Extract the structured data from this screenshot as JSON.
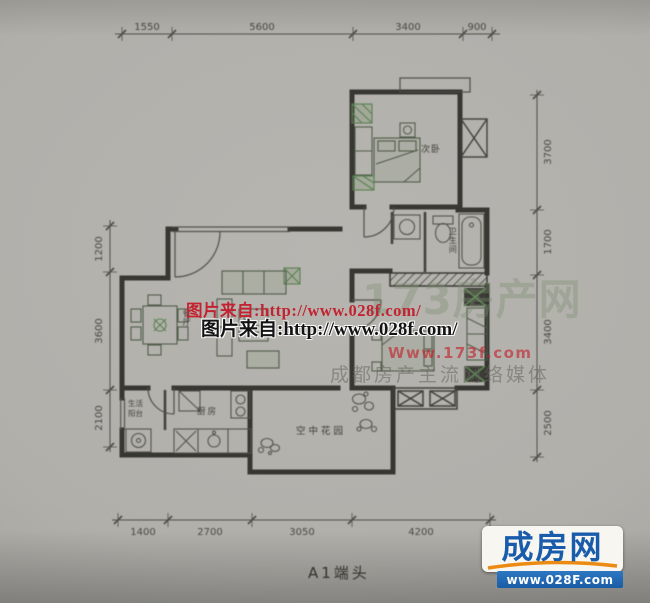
{
  "title": "A1端头",
  "dimensions": {
    "top": [
      "1550",
      "5600",
      "3400",
      "900"
    ],
    "bottom": [
      "1400",
      "2700",
      "3050",
      "4200"
    ],
    "left": [
      "1200",
      "3600",
      "2100"
    ],
    "right": [
      "3700",
      "1700",
      "3400",
      "2500"
    ]
  },
  "rooms": {
    "secondary_bedroom": "次卧",
    "bathroom": "卫生间",
    "dining": "餐厅",
    "kitchen": "厨房",
    "balcony_line1": "生活",
    "balcony_line2": "阳台",
    "sky_garden": "空中花园"
  },
  "watermarks": {
    "source_line_red": "图片来自:http://www.028f.com/",
    "source_line_black": "图片来自:http://www.028f.com/",
    "portal_name": "173房产网",
    "portal_url": "Www.173f.com",
    "portal_slogan": "成都房产主流网络媒体"
  },
  "logo": {
    "name": "成房网",
    "url": "www.028F.com",
    "colors": {
      "blue": "#1a5cac",
      "orange": "#ec8b12",
      "watermark_red": "#c32331"
    }
  }
}
